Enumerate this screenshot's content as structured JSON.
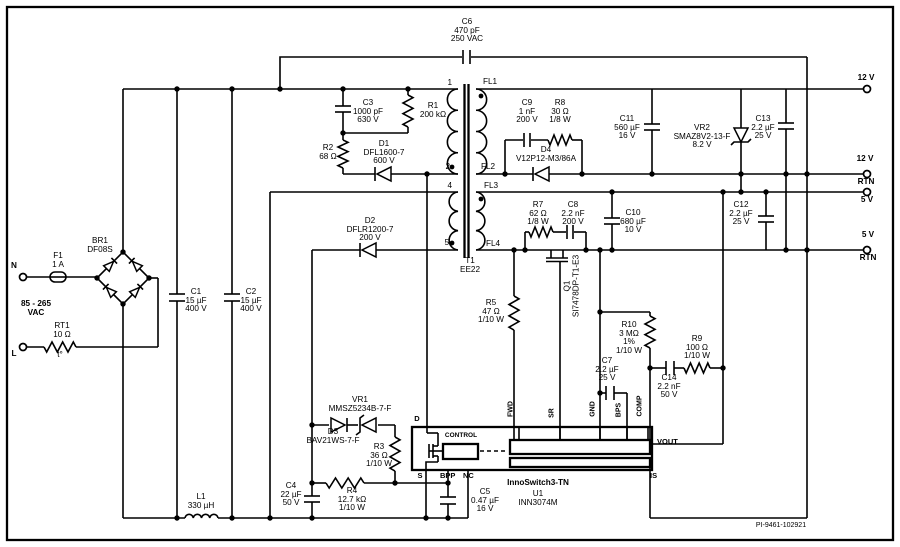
{
  "schematic": {
    "doc_number": "PI-9461-102921",
    "ic_name": "InnoSwitch3-TN",
    "ic_ref": "U1",
    "ic_part": "INN3074M",
    "input_range": "85 - 265 VAC",
    "outputs": [
      "12 V",
      "12 V RTN",
      "5 V",
      "5 V RTN"
    ],
    "colors": {
      "wire": "#000000",
      "background": "#ffffff"
    },
    "labels": [
      {
        "n": "label-c6",
        "x": 467,
        "y": 18,
        "l": [
          "C6",
          "470 pF",
          "250 VAC"
        ],
        "a": "c"
      },
      {
        "n": "label-c3",
        "x": 368,
        "y": 99,
        "l": [
          "C3",
          "1000 pF",
          "630 V"
        ],
        "a": "c"
      },
      {
        "n": "label-r1",
        "x": 433,
        "y": 102,
        "l": [
          "R1",
          "200 kΩ"
        ],
        "a": "c"
      },
      {
        "n": "label-r2",
        "x": 328,
        "y": 144,
        "l": [
          "R2",
          "68 Ω"
        ],
        "a": "c"
      },
      {
        "n": "label-d1",
        "x": 384,
        "y": 140,
        "l": [
          "D1",
          "DFL1600-7",
          "600 V"
        ],
        "a": "c"
      },
      {
        "n": "label-pin1",
        "x": 452,
        "y": 79,
        "l": [
          "1"
        ],
        "a": "r"
      },
      {
        "n": "label-pin2",
        "x": 450,
        "y": 163,
        "l": [
          "2"
        ],
        "a": "r"
      },
      {
        "n": "label-pin4",
        "x": 452,
        "y": 182,
        "l": [
          "4"
        ],
        "a": "r"
      },
      {
        "n": "label-pin5",
        "x": 449,
        "y": 239,
        "l": [
          "5"
        ],
        "a": "r"
      },
      {
        "n": "label-fl1",
        "x": 483,
        "y": 78,
        "l": [
          "FL1"
        ],
        "a": "l"
      },
      {
        "n": "label-fl2",
        "x": 481,
        "y": 163,
        "l": [
          "FL2"
        ],
        "a": "l"
      },
      {
        "n": "label-fl3",
        "x": 484,
        "y": 182,
        "l": [
          "FL3"
        ],
        "a": "l"
      },
      {
        "n": "label-fl4",
        "x": 486,
        "y": 240,
        "l": [
          "FL4"
        ],
        "a": "l"
      },
      {
        "n": "label-t1",
        "x": 470,
        "y": 257,
        "l": [
          "T1",
          "EE22"
        ],
        "a": "c"
      },
      {
        "n": "label-d2",
        "x": 370,
        "y": 217,
        "l": [
          "D2",
          "DFLR1200-7",
          "200 V"
        ],
        "a": "c"
      },
      {
        "n": "label-c9",
        "x": 527,
        "y": 99,
        "l": [
          "C9",
          "1 nF",
          "200 V"
        ],
        "a": "c"
      },
      {
        "n": "label-r8",
        "x": 560,
        "y": 99,
        "l": [
          "R8",
          "30 Ω",
          "1/8 W"
        ],
        "a": "c"
      },
      {
        "n": "label-d4",
        "x": 546,
        "y": 146,
        "l": [
          "D4",
          "V12P12-M3/86A"
        ],
        "a": "c"
      },
      {
        "n": "label-c11",
        "x": 627,
        "y": 115,
        "l": [
          "C11",
          "560 µF",
          "16 V"
        ],
        "a": "c"
      },
      {
        "n": "label-vr2",
        "x": 702,
        "y": 124,
        "l": [
          "VR2",
          "SMAZ8V2-13-F",
          "8.2 V"
        ],
        "a": "c"
      },
      {
        "n": "label-c13",
        "x": 763,
        "y": 115,
        "l": [
          "C13",
          "2.2 µF",
          "25 V"
        ],
        "a": "c"
      },
      {
        "n": "label-r7",
        "x": 538,
        "y": 201,
        "l": [
          "R7",
          "62 Ω",
          "1/8 W"
        ],
        "a": "c"
      },
      {
        "n": "label-c8",
        "x": 573,
        "y": 201,
        "l": [
          "C8",
          "2.2 nF",
          "200 V"
        ],
        "a": "c"
      },
      {
        "n": "label-c10",
        "x": 633,
        "y": 209,
        "l": [
          "C10",
          "680 µF",
          "10 V"
        ],
        "a": "c"
      },
      {
        "n": "label-q1",
        "x": 572,
        "y": 286,
        "l": [
          "Q1",
          "SI7478DP-T1-E3"
        ],
        "a": "c",
        "rot": -90
      },
      {
        "n": "label-r5",
        "x": 491,
        "y": 299,
        "l": [
          "R5",
          "47 Ω",
          "1/10 W"
        ],
        "a": "c"
      },
      {
        "n": "label-r10",
        "x": 629,
        "y": 321,
        "l": [
          "R10",
          "3 MΩ",
          "1%",
          "1/10 W"
        ],
        "a": "c"
      },
      {
        "n": "label-r9",
        "x": 697,
        "y": 335,
        "l": [
          "R9",
          "100 Ω",
          "1/10 W"
        ],
        "a": "c"
      },
      {
        "n": "label-c14",
        "x": 669,
        "y": 374,
        "l": [
          "C14",
          "2.2 nF",
          "50 V"
        ],
        "a": "c"
      },
      {
        "n": "label-c7",
        "x": 607,
        "y": 357,
        "l": [
          "C7",
          "2.2 µF",
          "25 V"
        ],
        "a": "c"
      },
      {
        "n": "label-c12",
        "x": 741,
        "y": 201,
        "l": [
          "C12",
          "2.2 µF",
          "25 V"
        ],
        "a": "c"
      },
      {
        "n": "label-vr1",
        "x": 360,
        "y": 396,
        "l": [
          "VR1",
          "MMSZ5234B-7-F"
        ],
        "a": "c"
      },
      {
        "n": "label-d3",
        "x": 333,
        "y": 428,
        "l": [
          "D3",
          "BAV21WS-7-F"
        ],
        "a": "c"
      },
      {
        "n": "label-r3",
        "x": 379,
        "y": 443,
        "l": [
          "R3",
          "36 Ω",
          "1/10 W"
        ],
        "a": "c"
      },
      {
        "n": "label-r4",
        "x": 352,
        "y": 487,
        "l": [
          "R4",
          "12.7 kΩ",
          "1/10 W"
        ],
        "a": "c"
      },
      {
        "n": "label-c4",
        "x": 291,
        "y": 482,
        "l": [
          "C4",
          "22 µF",
          "50 V"
        ],
        "a": "c"
      },
      {
        "n": "label-c5",
        "x": 485,
        "y": 488,
        "l": [
          "C5",
          "0.47 µF",
          "16 V"
        ],
        "a": "c"
      },
      {
        "n": "label-u1-name",
        "x": 538,
        "y": 479,
        "l": [
          "InnoSwitch3-TN"
        ],
        "a": "c",
        "b": 1
      },
      {
        "n": "label-u1-ref",
        "x": 538,
        "y": 490,
        "l": [
          "U1",
          "INN3074M"
        ],
        "a": "c"
      },
      {
        "n": "label-l1",
        "x": 201,
        "y": 493,
        "l": [
          "L1",
          "330 µH"
        ],
        "a": "c"
      },
      {
        "n": "label-c1",
        "x": 196,
        "y": 288,
        "l": [
          "C1",
          "15 µF",
          "400 V"
        ],
        "a": "c"
      },
      {
        "n": "label-c2",
        "x": 251,
        "y": 288,
        "l": [
          "C2",
          "15 µF",
          "400 V"
        ],
        "a": "c"
      },
      {
        "n": "label-br1",
        "x": 100,
        "y": 237,
        "l": [
          "BR1",
          "DF08S"
        ],
        "a": "c"
      },
      {
        "n": "label-f1",
        "x": 58,
        "y": 252,
        "l": [
          "F1",
          "1 A"
        ],
        "a": "c"
      },
      {
        "n": "label-rt1",
        "x": 62,
        "y": 322,
        "l": [
          "RT1",
          "10 Ω"
        ],
        "a": "c"
      },
      {
        "n": "label-rt1-t",
        "x": 60,
        "y": 351,
        "l": [
          "t°"
        ],
        "a": "c"
      },
      {
        "n": "label-vac",
        "x": 36,
        "y": 300,
        "l": [
          "85 - 265",
          "VAC"
        ],
        "a": "c",
        "b": 1
      },
      {
        "n": "label-n",
        "x": 14,
        "y": 262,
        "l": [
          "N"
        ],
        "a": "c",
        "b": 1
      },
      {
        "n": "label-l",
        "x": 14,
        "y": 350,
        "l": [
          "L"
        ],
        "a": "c",
        "b": 1
      },
      {
        "n": "label-out-12v",
        "x": 866,
        "y": 74,
        "l": [
          "12 V"
        ],
        "a": "c",
        "b": 1
      },
      {
        "n": "label-out-12v-rtn-a",
        "x": 865,
        "y": 155,
        "l": [
          "12 V"
        ],
        "a": "c",
        "b": 1
      },
      {
        "n": "label-out-12v-rtn-b",
        "x": 866,
        "y": 178,
        "l": [
          "RTN"
        ],
        "a": "c",
        "b": 1
      },
      {
        "n": "label-out-5v",
        "x": 867,
        "y": 196,
        "l": [
          "5 V"
        ],
        "a": "c",
        "b": 1
      },
      {
        "n": "label-out-5v-rtn-a",
        "x": 868,
        "y": 231,
        "l": [
          "5 V"
        ],
        "a": "c",
        "b": 1
      },
      {
        "n": "label-out-5v-rtn-b",
        "x": 868,
        "y": 254,
        "l": [
          "RTN"
        ],
        "a": "c",
        "b": 1
      },
      {
        "n": "label-pin-d",
        "x": 417,
        "y": 415,
        "l": [
          "D"
        ],
        "a": "c",
        "b": 1,
        "s": 7.5
      },
      {
        "n": "label-pin-s",
        "x": 420,
        "y": 472,
        "l": [
          "S"
        ],
        "a": "c",
        "b": 1,
        "s": 7.5
      },
      {
        "n": "label-pin-bpp",
        "x": 440,
        "y": 472,
        "l": [
          "BPP"
        ],
        "a": "l",
        "b": 1,
        "s": 7.5
      },
      {
        "n": "label-pin-nc",
        "x": 463,
        "y": 472,
        "l": [
          "NC"
        ],
        "a": "l",
        "b": 1,
        "s": 7.5
      },
      {
        "n": "label-pin-vout",
        "x": 657,
        "y": 438,
        "l": [
          "VOUT"
        ],
        "a": "l",
        "b": 1,
        "s": 7.5
      },
      {
        "n": "label-pin-is",
        "x": 650,
        "y": 472,
        "l": [
          "IS"
        ],
        "a": "l",
        "b": 1,
        "s": 7.5
      },
      {
        "n": "label-control",
        "x": 461,
        "y": 432,
        "l": [
          "CONTROL"
        ],
        "a": "c",
        "b": 1,
        "s": 6.5
      },
      {
        "n": "label-pin-fwd",
        "x": 512,
        "y": 409,
        "l": [
          "FWD"
        ],
        "a": "c",
        "b": 1,
        "s": 7,
        "rot": -90
      },
      {
        "n": "label-pin-sr",
        "x": 553,
        "y": 413,
        "l": [
          "SR"
        ],
        "a": "c",
        "b": 1,
        "s": 7,
        "rot": -90
      },
      {
        "n": "label-pin-gnd",
        "x": 594,
        "y": 409,
        "l": [
          "GND"
        ],
        "a": "c",
        "b": 1,
        "s": 7,
        "rot": -90
      },
      {
        "n": "label-pin-bps",
        "x": 620,
        "y": 410,
        "l": [
          "BPS"
        ],
        "a": "c",
        "b": 1,
        "s": 7,
        "rot": -90
      },
      {
        "n": "label-pin-comp",
        "x": 641,
        "y": 406,
        "l": [
          "COMP"
        ],
        "a": "c",
        "b": 1,
        "s": 7,
        "rot": -90
      },
      {
        "n": "label-docnum",
        "x": 781,
        "y": 522,
        "l": [
          "PI-9461-102921"
        ],
        "a": "c",
        "s": 7
      }
    ]
  }
}
